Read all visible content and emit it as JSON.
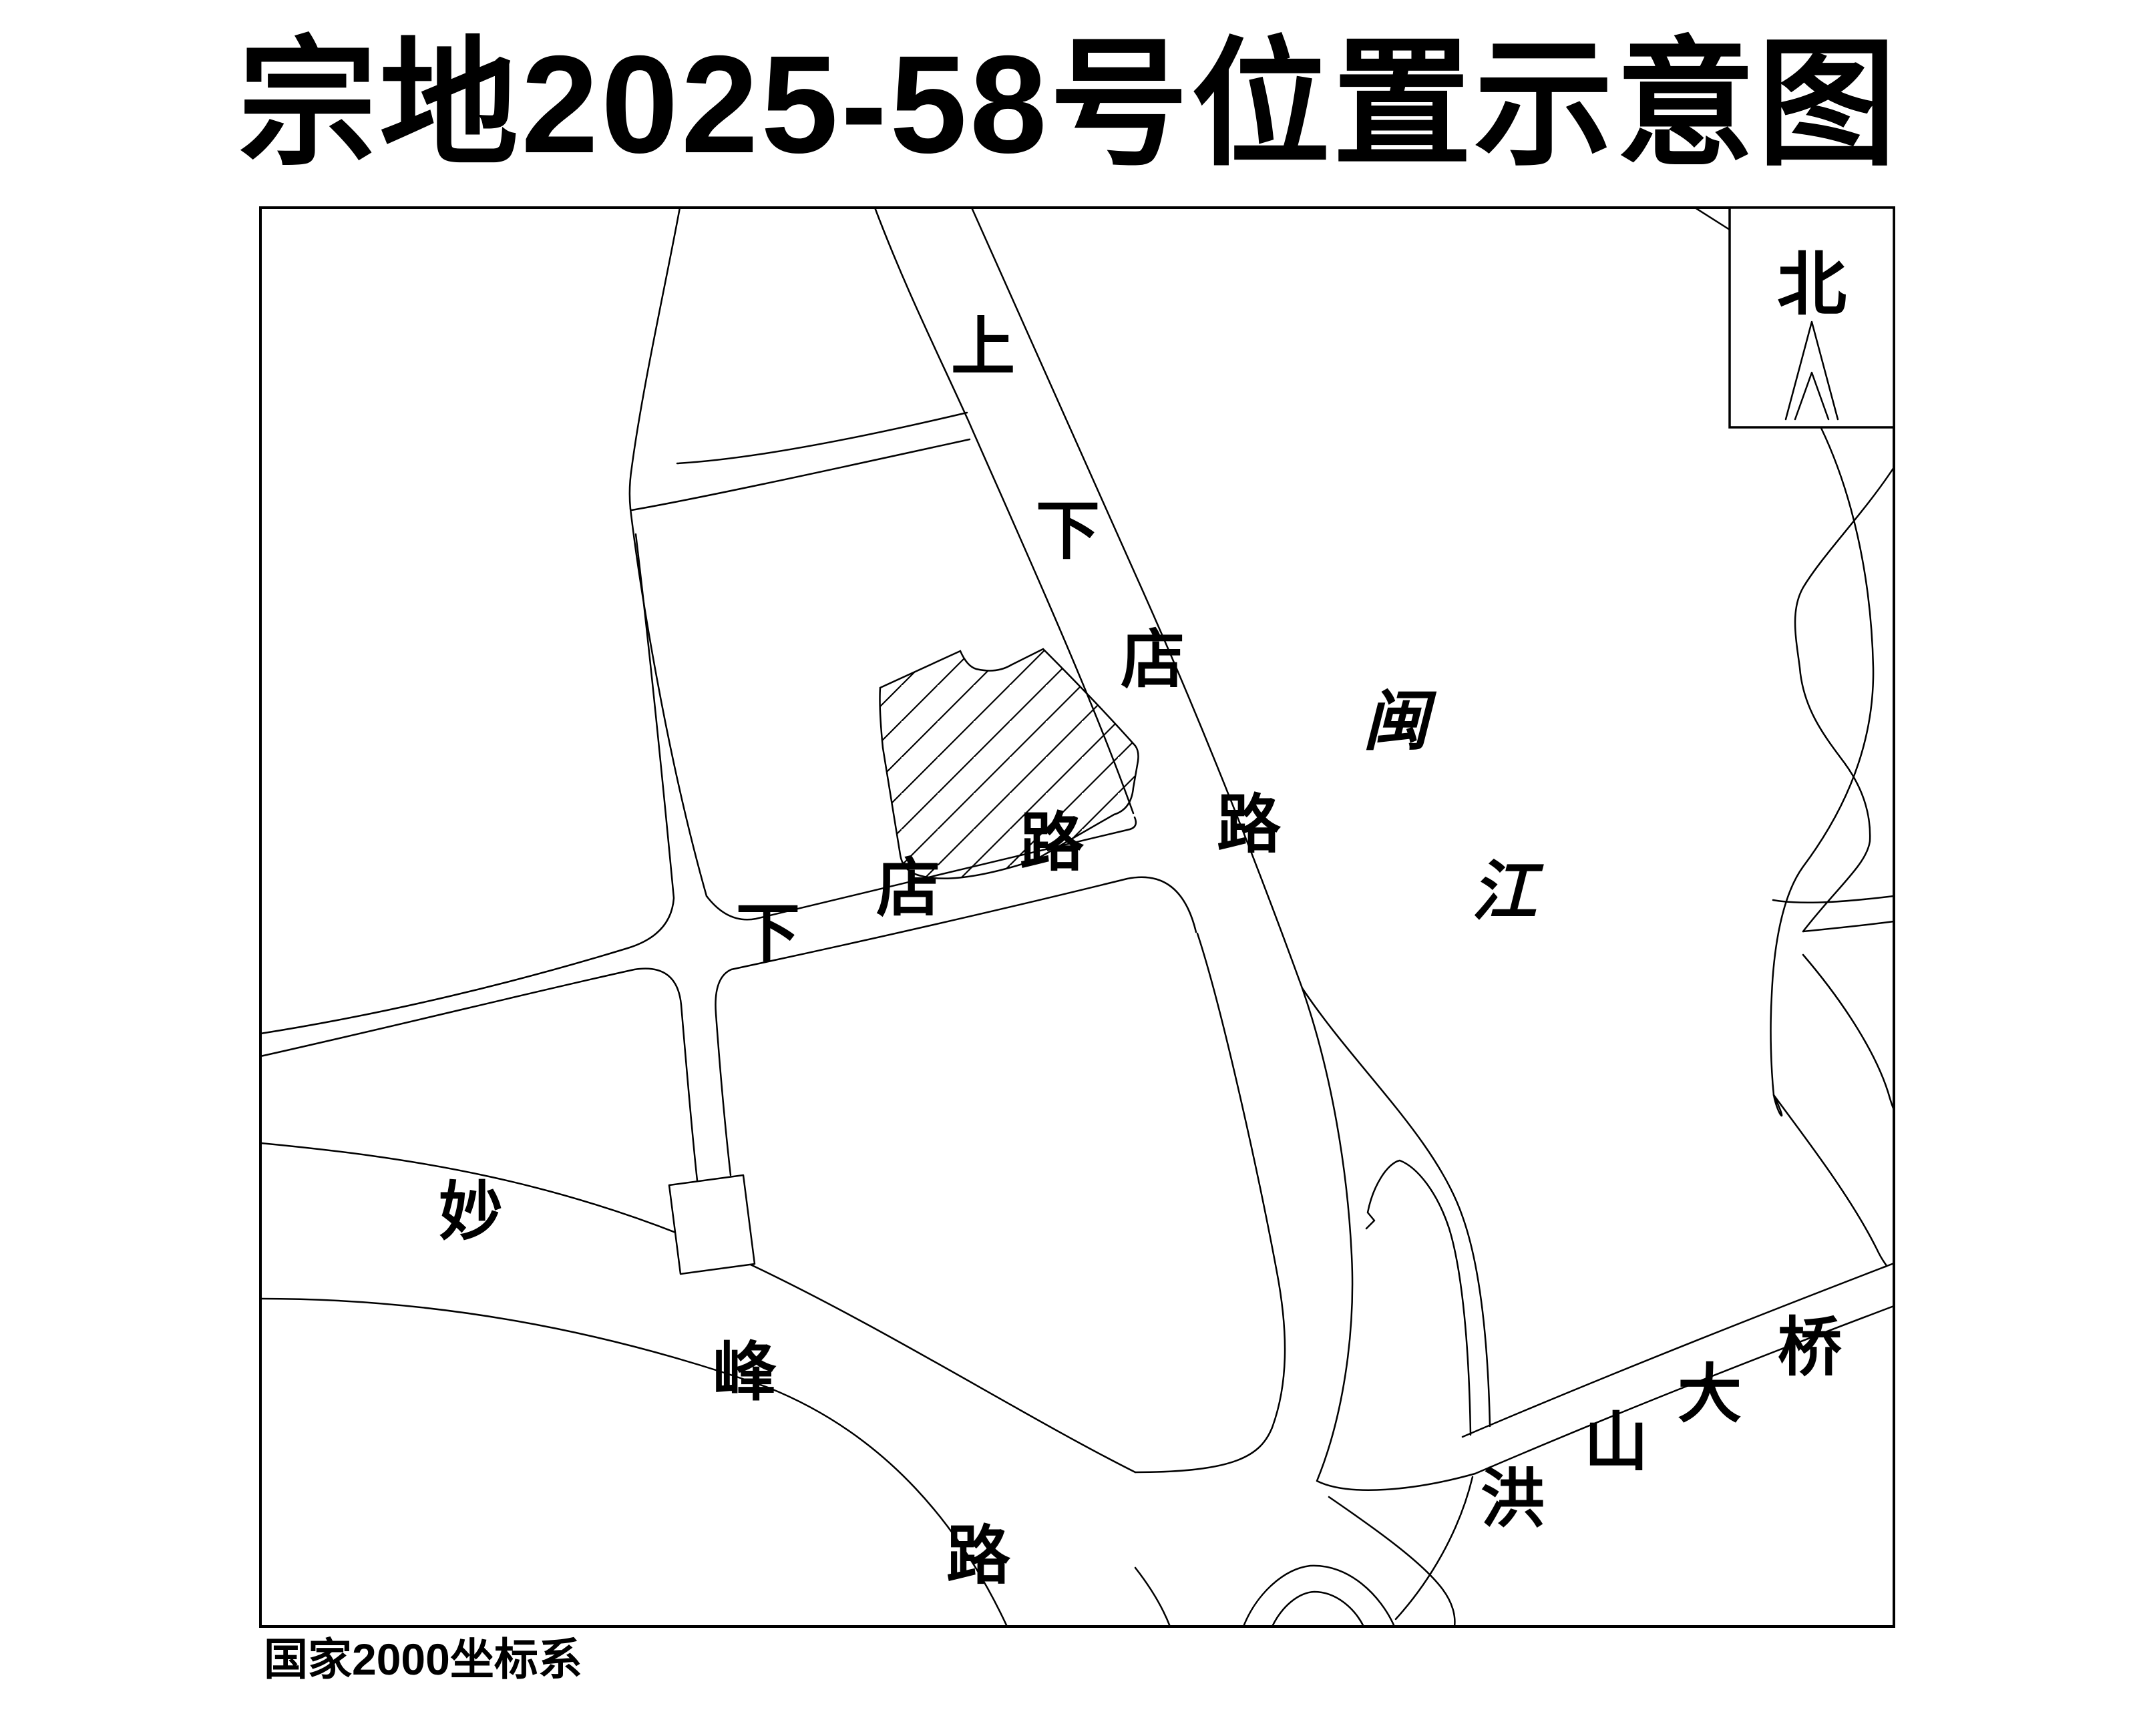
{
  "title": "宗地2025-58号位置示意图",
  "compass": {
    "label": "北"
  },
  "footer": {
    "datum": "国家2000坐标系"
  },
  "map_labels": {
    "shangxiadian_road": [
      "上",
      "下",
      "店",
      "路"
    ],
    "xiadian_road": [
      "下",
      "店",
      "路"
    ],
    "miaofeng_road": [
      "妙",
      "峰",
      "路"
    ],
    "hongshan_bridge": [
      "洪",
      "山",
      "大",
      "桥"
    ],
    "min_river": [
      "闽",
      "江"
    ]
  },
  "colors": {
    "line": "#000000",
    "background": "#ffffff"
  }
}
